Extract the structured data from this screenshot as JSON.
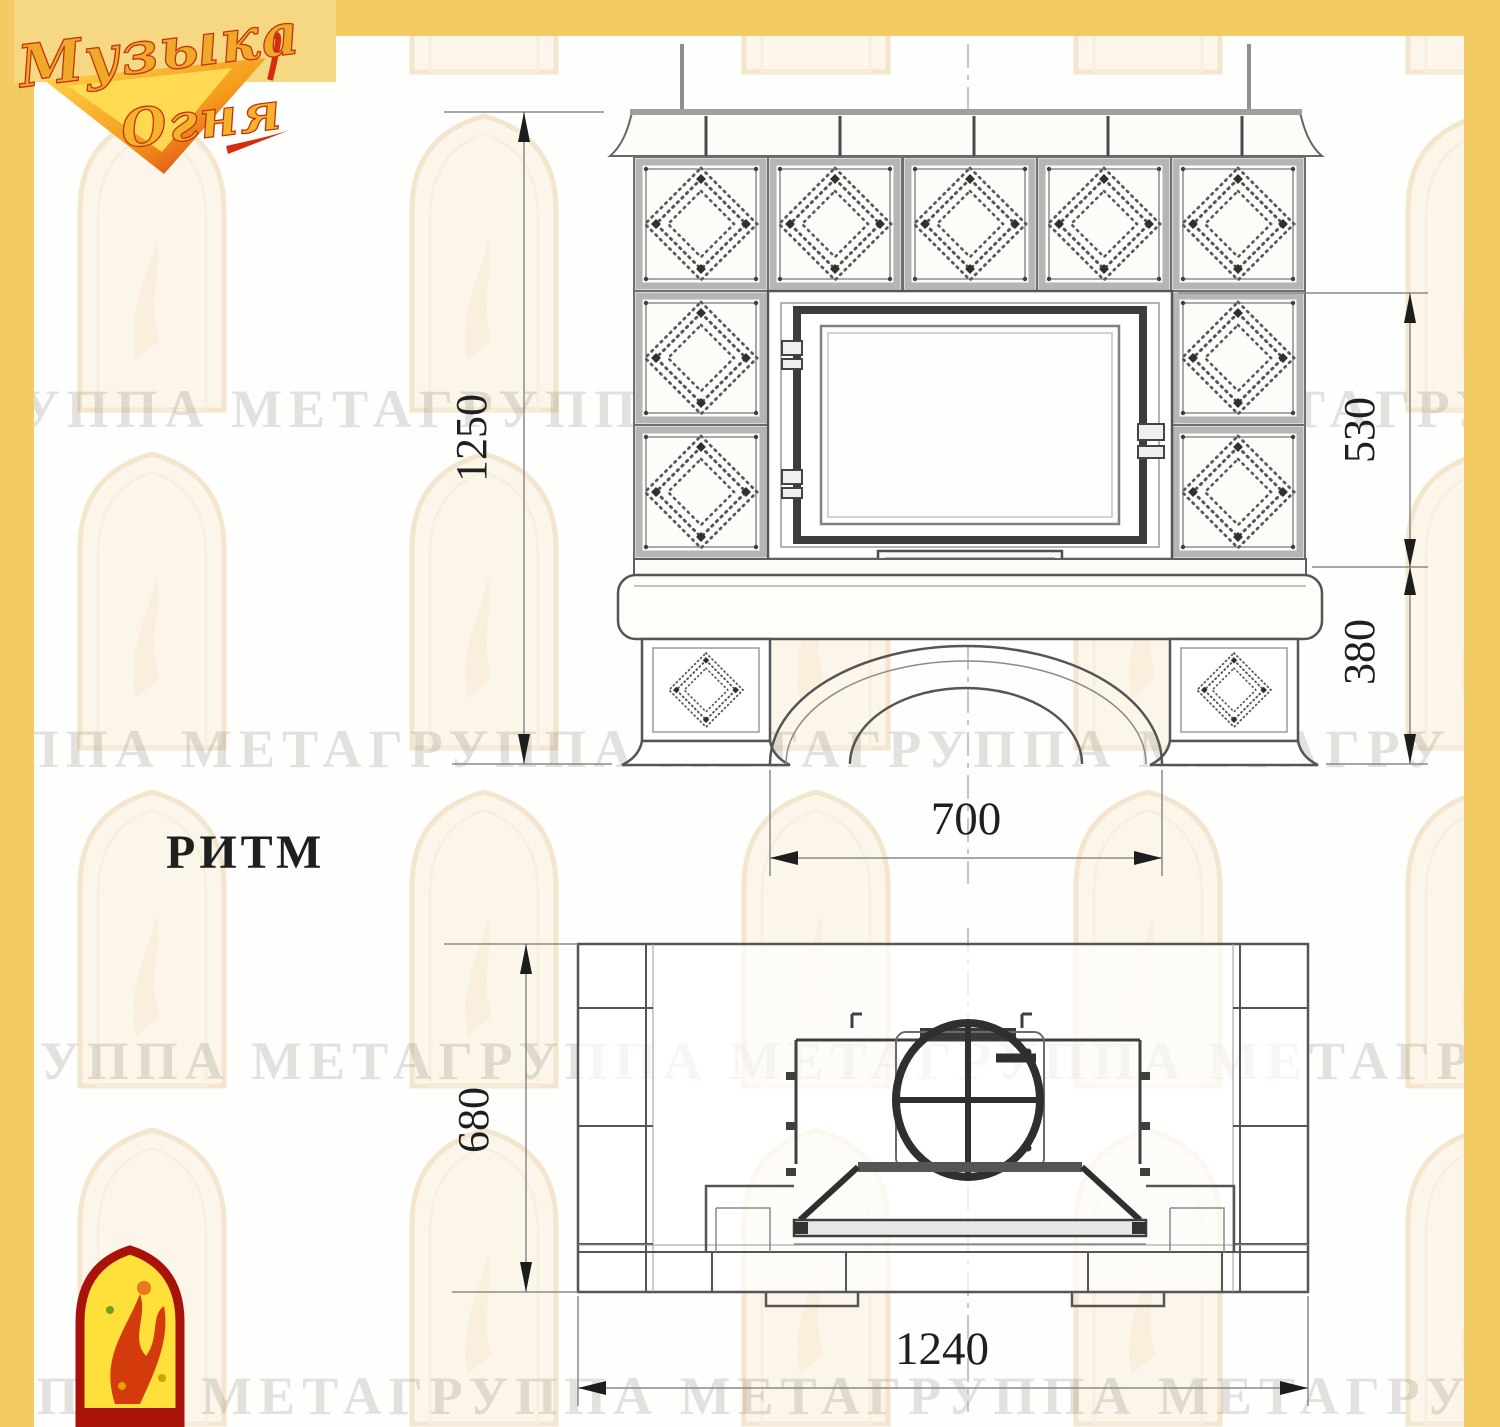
{
  "page": {
    "frame_color": "#F2CB62",
    "background": "#FEFEFD",
    "line_color": "#4A4A4A"
  },
  "brand": {
    "name_line1": "Музыка",
    "name_line2": "Огня",
    "gold": "#EFA928",
    "red": "#D32D12"
  },
  "watermark": {
    "text": "ГРУППА МЕТАГРУППА МЕТАГРУППА МЕТАГРУППА МЕТАГРУППА МЕТА"
  },
  "drawing": {
    "model_name": "РИТМ",
    "front_view": {
      "dimensions": {
        "total_height": "1250",
        "firebox_height": "530",
        "base_height": "380",
        "opening_width": "700"
      }
    },
    "plan_view": {
      "dimensions": {
        "depth": "680",
        "width": "1240"
      }
    }
  },
  "icons": {
    "corner_emblem": "firebird-arch-emblem",
    "flue_symbol": "flue-circle-with-cross"
  }
}
